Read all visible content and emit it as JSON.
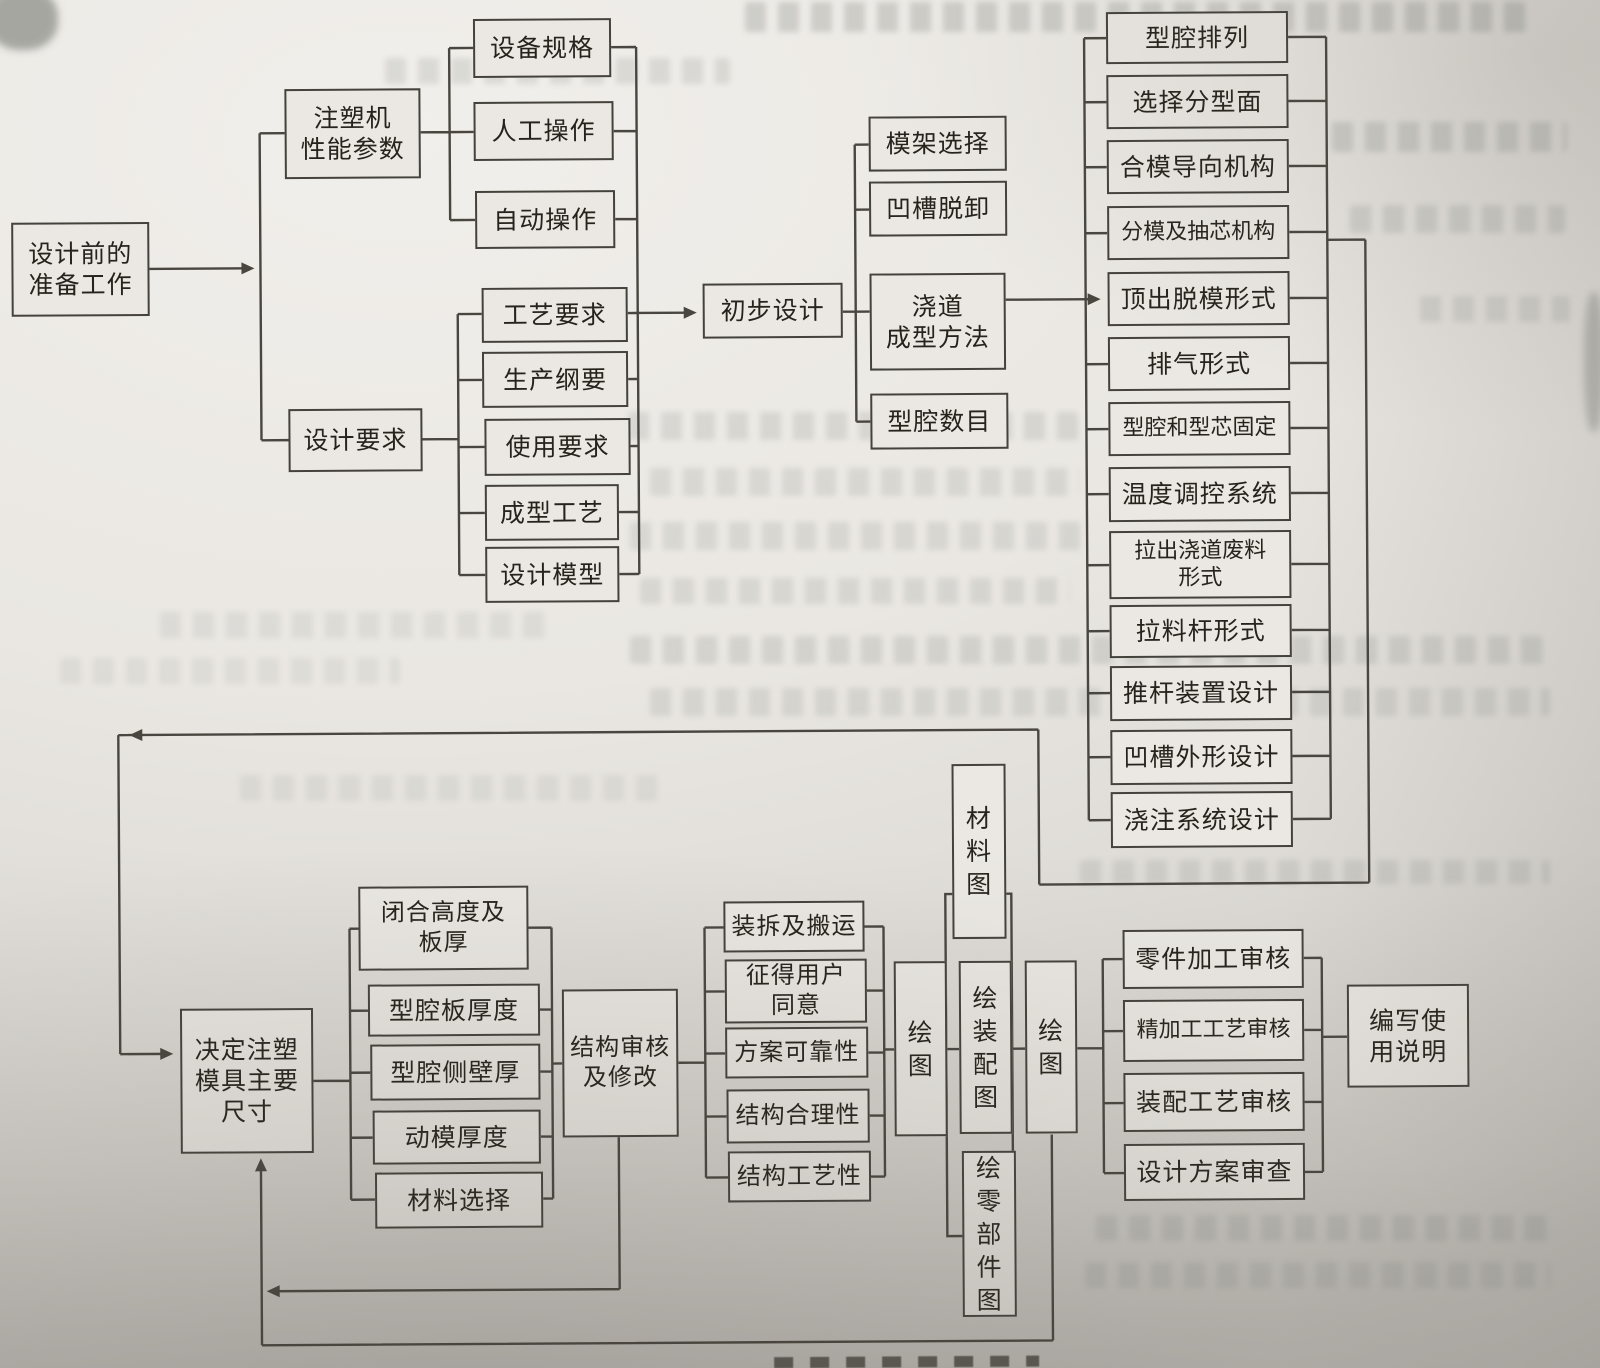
{
  "nodes": {
    "prep": [
      "设计前的",
      "准备工作"
    ],
    "machine_params": [
      "注塑机",
      "性能参数"
    ],
    "design_req": [
      "设计要求"
    ],
    "equip_spec": [
      "设备规格"
    ],
    "manual_op": [
      "人工操作"
    ],
    "auto_op": [
      "自动操作"
    ],
    "process_req": [
      "工艺要求"
    ],
    "production_outline": [
      "生产纲要"
    ],
    "usage_req": [
      "使用要求"
    ],
    "molding_process": [
      "成型工艺"
    ],
    "design_model": [
      "设计模型"
    ],
    "prelim_design": [
      "初步设计"
    ],
    "mold_base": [
      "模架选择"
    ],
    "groove_release": [
      "凹槽脱卸"
    ],
    "runner_method": [
      "浇道",
      "成型方法"
    ],
    "cavity_count": [
      "型腔数目"
    ],
    "cavity_layout": [
      "型腔排列"
    ],
    "parting_surface": [
      "选择分型面"
    ],
    "clamping_guide": [
      "合模导向机构"
    ],
    "parting_core_pulling": [
      "分模及抽芯机构"
    ],
    "ejection_form": [
      "顶出脱模形式"
    ],
    "venting_form": [
      "排气形式"
    ],
    "cavity_core_fixing": [
      "型腔和型芯固定"
    ],
    "temp_control": [
      "温度调控系统"
    ],
    "runner_waste": [
      "拉出浇道废料",
      "形式"
    ],
    "puller_rod": [
      "拉料杆形式"
    ],
    "ejector_device": [
      "推杆装置设计"
    ],
    "groove_profile": [
      "凹槽外形设计"
    ],
    "gating_system": [
      "浇注系统设计"
    ],
    "main_dims": [
      "决定注塑",
      "模具主要",
      "尺寸"
    ],
    "closing_height": [
      "闭合高度及",
      "板厚"
    ],
    "cavity_plate_thickness": [
      "型腔板厚度"
    ],
    "cavity_side_wall": [
      "型腔侧壁厚"
    ],
    "moving_mold_thickness": [
      "动模厚度"
    ],
    "material_selection": [
      "材料选择"
    ],
    "structure_review": [
      "结构审核",
      "及修改"
    ],
    "assembly_transport": [
      "装拆及搬运"
    ],
    "user_consent": [
      "征得用户",
      "同意"
    ],
    "plan_reliability": [
      "方案可靠性"
    ],
    "structure_rationality": [
      "结构合理性"
    ],
    "structure_manufacturability": [
      "结构工艺性"
    ],
    "draw_1": [
      "绘",
      "图"
    ],
    "material_drawing": [
      "材",
      "料",
      "图"
    ],
    "assembly_drawing": [
      "绘",
      "装",
      "配",
      "图"
    ],
    "parts_drawing": [
      "绘",
      "零",
      "部",
      "件",
      "图"
    ],
    "draw_2": [
      "绘",
      "图"
    ],
    "parts_machining_review": [
      "零件加工审核"
    ],
    "finishing_process_review": [
      "精加工工艺审核"
    ],
    "assembly_process_review": [
      "装配工艺审核"
    ],
    "design_plan_review": [
      "设计方案审查"
    ],
    "write_manual": [
      "编写使",
      "用说明"
    ]
  }
}
